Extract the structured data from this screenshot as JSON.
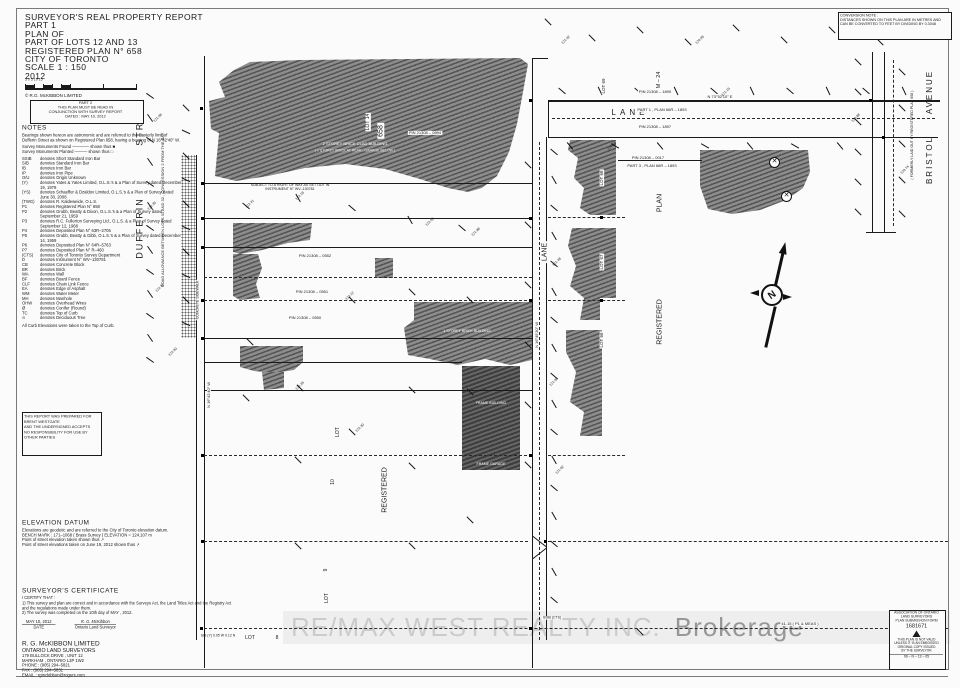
{
  "colors": {
    "paper": "#fbfbfb",
    "ink": "#1a1a1a",
    "hatch_light": "#8d8d8d",
    "hatch_dark": "#565656",
    "watermark_text": "#cbcbcb",
    "watermark_suffix": "#979797"
  },
  "title_block": {
    "lines": [
      "SURVEYOR'S REAL PROPERTY REPORT",
      "PART 1",
      "PLAN OF",
      "PART OF LOTS 12 AND 13",
      "REGISTERED PLAN N° 658",
      "CITY OF TORONTO",
      "SCALE   1 : 150",
      "2012"
    ]
  },
  "scale_numbers": "5       0          5         10         15",
  "copyright": "©   R.G. McKIBBON  LIMITED",
  "part2_box": {
    "lines": [
      "PART 2",
      "THIS PLAN MUST BE READ IN",
      "CONJUNCTION WITH SURVEY REPORT",
      "DATED :  MAY 10, 2012"
    ]
  },
  "conversion_note": {
    "lines": [
      "CONVERSION NOTE :",
      "DISTANCES SHOWN ON THIS PLAN ARE IN METRES AND",
      "CAN BE CONVERTED TO FEET BY DIVIDING BY 0.3048"
    ]
  },
  "notes": {
    "heading": "NOTES",
    "bearing_note": "Bearings shown hereon are astronomic and are referred to the Easterly limit of Dufferin Street as shown on Registered Plan 658, having a bearing of N 16°42'40\" W.",
    "monument_found": "Survey Monuments Found ———— shown thus  ■",
    "monument_planted": "Survey Monuments Planted ——— shown thus  □",
    "legend": [
      [
        "SSIB",
        "denotes Short Standard Iron Bar"
      ],
      [
        "SIB",
        "denotes Standard Iron Bar"
      ],
      [
        "IB",
        "denotes Iron Bar"
      ],
      [
        "IP",
        "denotes Iron Pipe"
      ],
      [
        "O/U",
        "denotes Origin Unknown"
      ],
      [
        "(Y)",
        "denotes Yates & Yates Limited, O.L.S.'s & a Plan of Survey dated December 19, 1979"
      ],
      [
        "(YS)",
        "denotes Schaeffer & Dzaldov Limited, O.L.S.'s & a Plan of Survey dated June 30, 2008"
      ],
      [
        "(TWG)",
        "denotes R. Kaldeweide, O.L.S."
      ],
      [
        "P1",
        "denotes Registered Plan N° 658"
      ],
      [
        "P2",
        "denotes Grubb, Beatty & Dixon, O.L.S.'s & a Plan of Survey dated September 21, 1959"
      ],
      [
        "P3",
        "denotes R.C. Fullerton Surveying Ltd., O.L.S. & a Plan of Survey dated September 12, 1968"
      ],
      [
        "P4",
        "denotes Deposited Plan N° 63R–2705"
      ],
      [
        "P5",
        "denotes Grubb, Beatty & Gibb, O.L.S.'s & a Plan of Survey dated December 14, 1959"
      ],
      [
        "P6",
        "denotes Deposited Plan N° 64R–5763"
      ],
      [
        "P7",
        "denotes Deposited Plan N° R–460"
      ],
      [
        "(CTS)",
        "denotes City of Toronto Survey Department"
      ],
      [
        "D",
        "denotes Instrument N° WV–130781"
      ],
      [
        "CB",
        "denotes Concrete Block"
      ],
      [
        "BR",
        "denotes Brick"
      ],
      [
        "WA",
        "denotes Wall"
      ],
      [
        "BF",
        "denotes Board Fence"
      ],
      [
        "CLF",
        "denotes Chain Link Fence"
      ],
      [
        "EA",
        "denotes Edge of Asphalt"
      ],
      [
        "WM",
        "denotes Water Meter"
      ],
      [
        "MH",
        "denotes Manhole"
      ],
      [
        "OHW",
        "denotes Overhead Wires"
      ],
      [
        "Ø",
        "denotes Conifer (Round)"
      ],
      [
        "TC",
        "denotes Top of Curb"
      ],
      [
        "⊙",
        "denotes Deciduous Tree"
      ]
    ],
    "footer": "All Curb Elevations were taken to the Top of Curb."
  },
  "report_box": {
    "lines": [
      "THIS REPORT WAS PREPARED FOR",
      "BRENT WESTGATE",
      "AND THE UNDERSIGNED ACCEPTS",
      "NO RESPONSIBILITY FOR USE BY",
      "OTHER PARTIES"
    ]
  },
  "elevation_datum": {
    "heading": "ELEVATION DATUM",
    "lines": [
      "Elevations are geodetic and are referred to the City of Toronto elevation datum.",
      "BENCH MARK : 171–1068 ( Brass Survey )        ELEVATION = 124.107 m",
      "Point of street elevation taken shown thus   ↗",
      "Point of street elevations taken on June 19, 2012 shown thus   ↗"
    ]
  },
  "certificate": {
    "heading": "SURVEYOR'S CERTIFICATE",
    "intro": "I CERTIFY THAT :",
    "items": [
      "1)   This survey and plan are correct and in accordance with the Surveys Act, the Land Titles Act and the Registry Act and the regulations made under them.",
      "2)   The survey was completed on the 10th day of MAY , 2012."
    ],
    "date_value": "MAY 10, 2012",
    "date_label": "DATE",
    "signature": "R. G. McKibbon",
    "signature_label": "Ontario Land Surveyor"
  },
  "firm": {
    "lines": [
      "R. G. McKIBBON LIMITED",
      "ONTARIO LAND SURVEYORS",
      "179 BULLOCK DRIVE , UNIT 12",
      "MARKHAM , ONTARIO   L3P 1W2",
      "PHONE : (905) 294–5821",
      "FAX : (905) 294–5831",
      "EMAIL : rgmckibbon@rogers.com"
    ]
  },
  "stamp": {
    "header": [
      "ASSOCIATION OF ONTARIO",
      "LAND SURVEYORS",
      "PLAN SUBMISSION FORM"
    ],
    "number": "1681671",
    "body": [
      "THIS PLAN IS NOT VALID",
      "UNLESS IT IS AN EMBOSSED",
      "ORIGINAL COPY ISSUED",
      "BY THE SURVEYOR"
    ],
    "footer": "96 – N – 13 – 05"
  },
  "watermark": {
    "text": "RE/MAX WEST REALTY INC.",
    "suffix": "Brokerage"
  },
  "north_arrow": {
    "label": "N"
  },
  "plan_labels": [
    {
      "t": "DUFFERIN",
      "x": 140,
      "y": 228,
      "r": -90,
      "fs": 9,
      "ls": 2
    },
    {
      "t": "STREET",
      "x": 140,
      "y": 122,
      "r": -90,
      "fs": 9,
      "ls": 2
    },
    {
      "t": "ROAD  ALLOWANCE  BETWEEN  LOTS  31  AND  32 ,  CONCESSION  2  FROM  THE  BAY",
      "x": 163,
      "y": 210,
      "r": -90,
      "fs": 4
    },
    {
      "t": "LOT  14",
      "x": 368,
      "y": 122,
      "r": -90,
      "fs": 5,
      "bg": 1
    },
    {
      "t": "658",
      "x": 381,
      "y": 131,
      "r": -90,
      "fs": 7,
      "bg": 1
    },
    {
      "t": "LOT  69",
      "x": 604,
      "y": 86,
      "r": -90,
      "fs": 4.5,
      "bg": 1
    },
    {
      "t": "M – 24",
      "x": 659,
      "y": 80,
      "r": -90,
      "fs": 5.5,
      "bg": 1
    },
    {
      "t": "LANE",
      "x": 630,
      "y": 113,
      "fs": 8,
      "ls": 4,
      "bg": 1
    },
    {
      "t": "LANE",
      "x": 545,
      "y": 252,
      "r": -90,
      "fs": 7,
      "bg": 1
    },
    {
      "t": "PLAN",
      "x": 660,
      "y": 203,
      "r": -90,
      "fs": 7
    },
    {
      "t": "REGISTERED",
      "x": 660,
      "y": 322,
      "r": -90,
      "fs": 7
    },
    {
      "t": "LOT  68",
      "x": 602,
      "y": 178,
      "r": -90,
      "fs": 4.5,
      "bg": 1
    },
    {
      "t": "LOT  67",
      "x": 602,
      "y": 262,
      "r": -90,
      "fs": 4.5,
      "bg": 1
    },
    {
      "t": "LOT  66",
      "x": 602,
      "y": 340,
      "r": -90,
      "fs": 4.5,
      "bg": 1
    },
    {
      "t": "LOT",
      "x": 338,
      "y": 432,
      "r": -90,
      "fs": 5,
      "bg": 1
    },
    {
      "t": "10",
      "x": 333,
      "y": 482,
      "r": -90,
      "fs": 5,
      "bg": 1
    },
    {
      "t": "REGISTERED",
      "x": 385,
      "y": 490,
      "r": -90,
      "fs": 7
    },
    {
      "t": "LOT",
      "x": 327,
      "y": 598,
      "r": -90,
      "fs": 5,
      "bg": 1
    },
    {
      "t": "9",
      "x": 326,
      "y": 570,
      "r": -90,
      "fs": 5,
      "bg": 1
    },
    {
      "t": "LOT",
      "x": 250,
      "y": 638,
      "fs": 5
    },
    {
      "t": "8",
      "x": 277,
      "y": 638,
      "fs": 5
    },
    {
      "t": "BRISTOL",
      "x": 930,
      "y": 160,
      "r": -90,
      "fs": 8,
      "ls": 2
    },
    {
      "t": "AVENUE",
      "x": 930,
      "y": 92,
      "r": -90,
      "fs": 8,
      "ls": 2
    },
    {
      "t": "( FORMERLY LAID OUT BY REGISTERED PLAN 658 )",
      "x": 912,
      "y": 135,
      "r": -90,
      "fs": 3.6
    },
    {
      "t": "PIN  21308 – 0894",
      "x": 425,
      "y": 133,
      "fs": 4,
      "bg": 1
    },
    {
      "t": "PIN  21308 – 1890",
      "x": 655,
      "y": 92,
      "fs": 4,
      "bg": 1
    },
    {
      "t": "PART  1 ,  PLAN  66R – 1893",
      "x": 662,
      "y": 110,
      "fs": 4,
      "bg": 1
    },
    {
      "t": "PIN  21308 – 1897",
      "x": 655,
      "y": 127,
      "fs": 4,
      "bg": 1
    },
    {
      "t": "PIN  21308 – 0017",
      "x": 648,
      "y": 158,
      "fs": 4,
      "bg": 1
    },
    {
      "t": "PART  3 ,  PLAN  66R – 1893",
      "x": 652,
      "y": 166,
      "fs": 4,
      "bg": 1
    },
    {
      "t": "PIN  21308 – 0552",
      "x": 315,
      "y": 256,
      "fs": 4,
      "bg": 1
    },
    {
      "t": "PIN  21308 – 0551",
      "x": 312,
      "y": 292,
      "fs": 4,
      "bg": 1
    },
    {
      "t": "PIN  21308 – 0550",
      "x": 305,
      "y": 318,
      "fs": 4,
      "bg": 1
    },
    {
      "t": "SUBJECT TO A RIGHT OF WAY AS SET OUT IN INSTRUMENT N° WV–130781",
      "x": 290,
      "y": 187,
      "fs": 3.6,
      "w": 95
    },
    {
      "t": "2 STOREY BRICK CLAD BUILDING",
      "x": 355,
      "y": 144,
      "fs": 4,
      "c": "#ffffff"
    },
    {
      "t": "( 1 STOREY BRICK AT REAR , GARAGE BELOW )",
      "x": 355,
      "y": 151,
      "fs": 3.5,
      "c": "#eeeeee"
    },
    {
      "t": "1 STOREY BRICK BUILDING",
      "x": 467,
      "y": 331,
      "fs": 3.6,
      "c": "#ffffff"
    },
    {
      "t": "FRAME BUILDING",
      "x": 491,
      "y": 403,
      "fs": 3.6,
      "c": "#ffffff"
    },
    {
      "t": "FRAME GARAGE",
      "x": 491,
      "y": 464,
      "fs": 3.6,
      "c": "#ffffff"
    },
    {
      "t": "N 16°42'40\" W",
      "x": 209,
      "y": 395,
      "r": -90,
      "fs": 4,
      "bg": 1
    },
    {
      "t": "N 16°45'30\" W",
      "x": 537,
      "y": 335,
      "r": -90,
      "fs": 4,
      "bg": 1
    },
    {
      "t": "N 73°52'10\" E",
      "x": 720,
      "y": 97,
      "fs": 4,
      "bg": 1
    },
    {
      "t": "41.15  ( P1 & MEAS )",
      "x": 800,
      "y": 624,
      "fs": 4,
      "bg": 1
    },
    {
      "t": "SSIB (CTS)",
      "x": 552,
      "y": 618,
      "fs": 3.5,
      "bg": 1
    },
    {
      "t": "SIB (Y)  0.05 W  0.12 N",
      "x": 218,
      "y": 636,
      "fs": 3.5,
      "w": 40
    },
    {
      "t": "CONCRETE  SIDEWALK",
      "x": 198,
      "y": 300,
      "r": -90,
      "fs": 3.5,
      "bg": 1
    }
  ],
  "ticks": [
    [
      150,
      96,
      35
    ],
    [
      150,
      118,
      55
    ],
    [
      150,
      140,
      35
    ],
    [
      150,
      162,
      55
    ],
    [
      150,
      184,
      35
    ],
    [
      150,
      206,
      55
    ],
    [
      150,
      228,
      35
    ],
    [
      150,
      250,
      55
    ],
    [
      150,
      272,
      35
    ],
    [
      150,
      294,
      55
    ],
    [
      150,
      316,
      35
    ],
    [
      150,
      338,
      55
    ],
    [
      150,
      360,
      35
    ],
    [
      186,
      108,
      45
    ],
    [
      186,
      132,
      25
    ],
    [
      186,
      156,
      45
    ],
    [
      186,
      180,
      25
    ],
    [
      186,
      204,
      45
    ],
    [
      186,
      228,
      25
    ],
    [
      186,
      252,
      45
    ],
    [
      186,
      276,
      25
    ],
    [
      186,
      300,
      45
    ],
    [
      186,
      324,
      25
    ],
    [
      554,
      152,
      40
    ],
    [
      554,
      180,
      60
    ],
    [
      554,
      208,
      40
    ],
    [
      554,
      236,
      60
    ],
    [
      554,
      264,
      40
    ],
    [
      554,
      292,
      60
    ],
    [
      554,
      320,
      40
    ],
    [
      554,
      348,
      60
    ],
    [
      554,
      376,
      40
    ],
    [
      554,
      404,
      60
    ],
    [
      554,
      432,
      40
    ],
    [
      554,
      460,
      60
    ],
    [
      554,
      488,
      40
    ],
    [
      554,
      516,
      60
    ],
    [
      554,
      544,
      40
    ],
    [
      554,
      572,
      60
    ],
    [
      554,
      600,
      40
    ],
    [
      528,
      165,
      45
    ],
    [
      528,
      225,
      45
    ],
    [
      528,
      285,
      45
    ],
    [
      528,
      345,
      45
    ],
    [
      528,
      405,
      45
    ],
    [
      528,
      465,
      45
    ],
    [
      562,
      91,
      40
    ],
    [
      600,
      91,
      65
    ],
    [
      638,
      91,
      40
    ],
    [
      676,
      91,
      65
    ],
    [
      714,
      91,
      40
    ],
    [
      752,
      91,
      65
    ],
    [
      790,
      91,
      40
    ],
    [
      828,
      91,
      65
    ],
    [
      866,
      91,
      40
    ],
    [
      904,
      91,
      65
    ],
    [
      570,
      146,
      50
    ],
    [
      615,
      146,
      30
    ],
    [
      660,
      146,
      50
    ],
    [
      705,
      146,
      30
    ],
    [
      750,
      146,
      50
    ],
    [
      795,
      146,
      30
    ],
    [
      840,
      146,
      50
    ],
    [
      858,
      62,
      45
    ],
    [
      858,
      92,
      45
    ],
    [
      858,
      122,
      45
    ],
    [
      858,
      152,
      45
    ],
    [
      858,
      182,
      45
    ],
    [
      858,
      212,
      45
    ],
    [
      902,
      72,
      45
    ],
    [
      902,
      108,
      45
    ],
    [
      902,
      144,
      45
    ],
    [
      902,
      180,
      45
    ],
    [
      902,
      214,
      45
    ],
    [
      548,
      22,
      45
    ],
    [
      592,
      38,
      45
    ],
    [
      640,
      30,
      45
    ],
    [
      688,
      42,
      45
    ],
    [
      736,
      28,
      45
    ],
    [
      784,
      40,
      45
    ],
    [
      832,
      30,
      45
    ],
    [
      880,
      42,
      45
    ],
    [
      928,
      26,
      45
    ],
    [
      246,
      206,
      40
    ],
    [
      298,
      198,
      60
    ],
    [
      352,
      208,
      40
    ],
    [
      410,
      220,
      60
    ],
    [
      462,
      228,
      40
    ],
    [
      250,
      342,
      45
    ],
    [
      300,
      388,
      45
    ],
    [
      352,
      300,
      45
    ],
    [
      412,
      292,
      45
    ],
    [
      470,
      300,
      45
    ],
    [
      246,
      398,
      45
    ],
    [
      352,
      432,
      45
    ],
    [
      412,
      390,
      45
    ],
    [
      470,
      392,
      45
    ],
    [
      298,
      460,
      45
    ],
    [
      412,
      466,
      45
    ],
    [
      470,
      520,
      45
    ],
    [
      298,
      546,
      45
    ],
    [
      412,
      546,
      45
    ],
    [
      640,
      632,
      45
    ]
  ],
  "tick_labels": [
    [
      "121.96",
      158,
      118
    ],
    [
      "122.35",
      152,
      206
    ],
    [
      "122.71",
      160,
      288
    ],
    [
      "122.90",
      173,
      352
    ],
    [
      "121.48",
      557,
      262
    ],
    [
      "121.90",
      554,
      382
    ],
    [
      "121.62",
      560,
      470
    ],
    [
      "121.15",
      726,
      92
    ],
    [
      "121.58",
      612,
      146
    ],
    [
      "120.88",
      856,
      118
    ],
    [
      "120.74",
      905,
      170
    ],
    [
      "122.41",
      250,
      204
    ],
    [
      "122.18",
      300,
      196
    ],
    [
      "122.05",
      430,
      222
    ],
    [
      "121.88",
      476,
      232
    ],
    [
      "122.12",
      350,
      296
    ],
    [
      "122.26",
      300,
      386
    ],
    [
      "122.30",
      360,
      428
    ],
    [
      "121.02",
      566,
      40
    ],
    [
      "120.95",
      700,
      40
    ]
  ],
  "monuments": [
    [
      202,
      183
    ],
    [
      202,
      218
    ],
    [
      202,
      247
    ],
    [
      202,
      300
    ],
    [
      202,
      338
    ],
    [
      202,
      455
    ],
    [
      202,
      541
    ],
    [
      530,
      100
    ],
    [
      530,
      218
    ],
    [
      530,
      300
    ],
    [
      530,
      455
    ],
    [
      545,
      541
    ],
    [
      530,
      628
    ],
    [
      870,
      100
    ],
    [
      883,
      137
    ],
    [
      601,
      217
    ],
    [
      601,
      300
    ],
    [
      201,
      628
    ],
    [
      201,
      108
    ]
  ],
  "trees": [
    [
      774,
      162
    ],
    [
      786,
      196
    ]
  ]
}
